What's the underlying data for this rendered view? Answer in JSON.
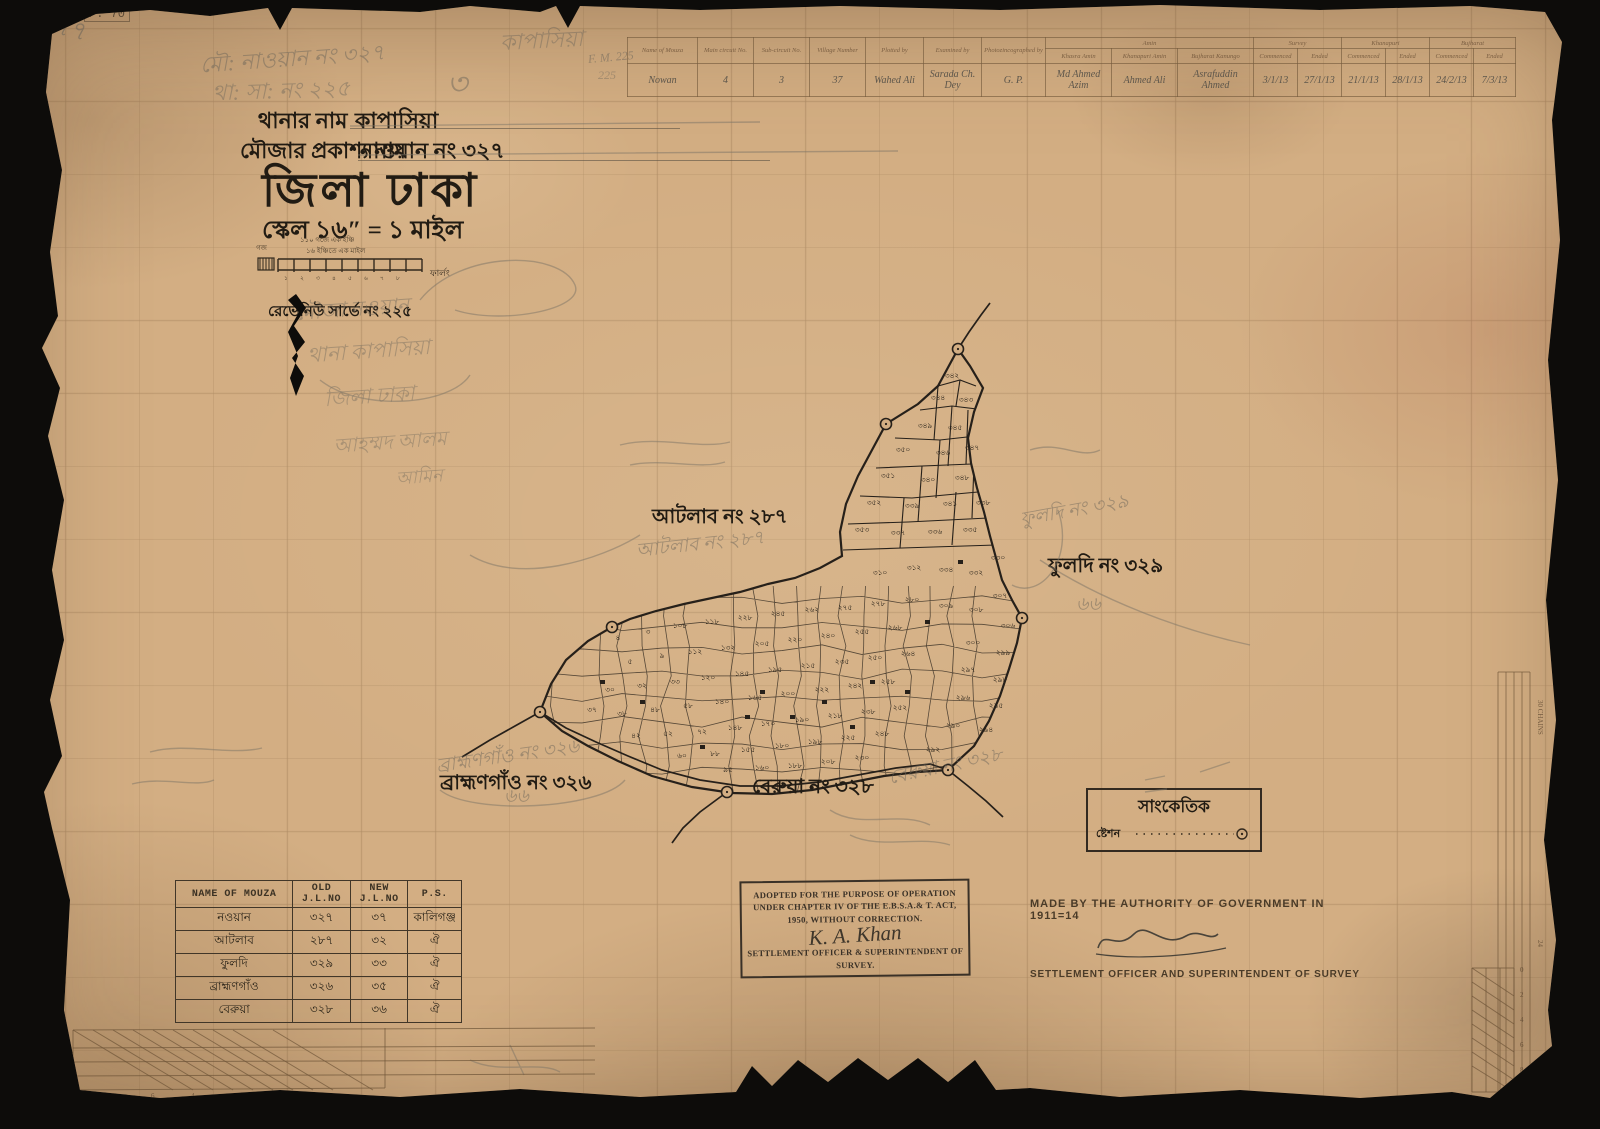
{
  "colors": {
    "paper": "#d3ae83",
    "ink": "#26201a",
    "pencil": "#6e675b",
    "faint_print": "#75583c"
  },
  "header": {
    "line1_label": "থানার নাম",
    "line1_value": "কাপাসিয়া",
    "line2_label": "মৌজার প্রকাশ্য নাম",
    "line2_value": "নাওয়ান নং ৩২৭",
    "district": "জিলা ঢাকা",
    "scale": "স্কেল ১৬″ = ১ মাইল",
    "scalebar_top": "১১০ গজে এক ইঞ্চি",
    "scalebar_bottom": "১৬ ইঞ্চিতে এক মাইল",
    "scalebar_left": "গজ",
    "scalebar_right": "ফার্লং",
    "revenue": "রেভেনিউ সার্ভে নং ২২৫"
  },
  "register": {
    "left_headers": [
      "Name of Mouza",
      "Main circuit No.",
      "Sub-circuit No.",
      "Village Number",
      "Plotted by",
      "Examined by",
      "Photozincographed by"
    ],
    "groups": [
      {
        "label": "Amin",
        "span": 3
      },
      {
        "label": "Survey",
        "span": 2
      },
      {
        "label": "Khanapuri",
        "span": 2
      },
      {
        "label": "Bujharat",
        "span": 2
      }
    ],
    "sub_headers": [
      "Khasra Amin",
      "Khanapuri Amin",
      "Bujharat Kanungo",
      "Commenced",
      "Ended",
      "Commenced",
      "Ended",
      "Commenced",
      "Ended"
    ],
    "row": [
      "Nowan",
      "4",
      "3",
      "37",
      "Wahed Ali",
      "Sarada Ch. Dey",
      "G. P.",
      "Md Ahmed Azim",
      "Ahmed Ali",
      "Asrafuddin Ahmed",
      "3/1/13",
      "27/1/13",
      "21/1/13",
      "28/1/13",
      "24/2/13",
      "7/3/13"
    ]
  },
  "map": {
    "labels": [
      {
        "text": "আটলাব নং ২৮৭",
        "x": 652,
        "y": 502
      },
      {
        "text": "ফুলদি নং ৩২৯",
        "x": 1048,
        "y": 551
      },
      {
        "text": "ব্রাহ্মণগাঁও নং ৩২৬",
        "x": 440,
        "y": 768
      },
      {
        "text": "বেরুয়া নং ৩২৮",
        "x": 752,
        "y": 772
      }
    ],
    "pencil_labels": [
      {
        "text": "আটলাব নং ২৮৭",
        "x": 636,
        "y": 530,
        "r": -6
      },
      {
        "text": "ফুলদি নং ৩২৯",
        "x": 1020,
        "y": 496,
        "r": -10
      },
      {
        "text": "৬৬",
        "x": 1076,
        "y": 590,
        "r": 0
      },
      {
        "text": "বেরুয়া নং ৩২৮",
        "x": 888,
        "y": 752,
        "r": -12
      },
      {
        "text": "ব্রাহ্মণগাঁও নং ৩২৬",
        "x": 436,
        "y": 742,
        "r": -8
      },
      {
        "text": "৬৬",
        "x": 504,
        "y": 782,
        "r": 0
      }
    ],
    "outline": [
      [
        958,
        349
      ],
      [
        938,
        386
      ],
      [
        918,
        404
      ],
      [
        886,
        424
      ],
      [
        872,
        450
      ],
      [
        858,
        476
      ],
      [
        846,
        504
      ],
      [
        840,
        532
      ],
      [
        842,
        556
      ],
      [
        820,
        568
      ],
      [
        795,
        578
      ],
      [
        768,
        584
      ],
      [
        740,
        592
      ],
      [
        712,
        598
      ],
      [
        684,
        604
      ],
      [
        656,
        611
      ],
      [
        630,
        619
      ],
      [
        612,
        627
      ],
      [
        588,
        641
      ],
      [
        566,
        660
      ],
      [
        551,
        684
      ],
      [
        540,
        712
      ],
      [
        562,
        731
      ],
      [
        588,
        746
      ],
      [
        618,
        761
      ],
      [
        652,
        776
      ],
      [
        692,
        787
      ],
      [
        732,
        793
      ],
      [
        772,
        794
      ],
      [
        812,
        790
      ],
      [
        848,
        783
      ],
      [
        884,
        776
      ],
      [
        918,
        772
      ],
      [
        948,
        770
      ],
      [
        974,
        746
      ],
      [
        989,
        721
      ],
      [
        1000,
        696
      ],
      [
        1009,
        669
      ],
      [
        1017,
        643
      ],
      [
        1022,
        618
      ],
      [
        1012,
        600
      ],
      [
        1002,
        580
      ],
      [
        996,
        558
      ],
      [
        990,
        536
      ],
      [
        984,
        512
      ],
      [
        977,
        488
      ],
      [
        971,
        463
      ],
      [
        968,
        438
      ],
      [
        974,
        412
      ],
      [
        983,
        388
      ],
      [
        970,
        366
      ]
    ],
    "segments": [
      [
        [
          938,
          386
        ],
        [
          960,
          380
        ],
        [
          976,
          386
        ]
      ],
      [
        [
          920,
          410
        ],
        [
          952,
          406
        ],
        [
          985,
          410
        ]
      ],
      [
        [
          895,
          438
        ],
        [
          940,
          440
        ],
        [
          976,
          436
        ]
      ],
      [
        [
          876,
          468
        ],
        [
          922,
          466
        ],
        [
          972,
          464
        ]
      ],
      [
        [
          860,
          496
        ],
        [
          912,
          498
        ],
        [
          978,
          492
        ]
      ],
      [
        [
          848,
          524
        ],
        [
          908,
          522
        ],
        [
          988,
          518
        ]
      ],
      [
        [
          843,
          550
        ],
        [
          902,
          548
        ],
        [
          996,
          545
        ]
      ],
      [
        [
          960,
          380
        ],
        [
          956,
          406
        ]
      ],
      [
        [
          938,
          386
        ],
        [
          934,
          440
        ]
      ],
      [
        [
          952,
          406
        ],
        [
          948,
          466
        ]
      ],
      [
        [
          922,
          466
        ],
        [
          918,
          522
        ]
      ],
      [
        [
          940,
          440
        ],
        [
          936,
          498
        ]
      ],
      [
        [
          968,
          410
        ],
        [
          966,
          464
        ]
      ],
      [
        [
          974,
          464
        ],
        [
          972,
          518
        ]
      ],
      [
        [
          904,
          498
        ],
        [
          900,
          548
        ]
      ],
      [
        [
          956,
          492
        ],
        [
          952,
          545
        ]
      ]
    ],
    "roads": [
      [
        [
          540,
          712
        ],
        [
          566,
          728
        ],
        [
          596,
          742
        ],
        [
          628,
          756
        ],
        [
          662,
          770
        ],
        [
          700,
          780
        ],
        [
          740,
          786
        ],
        [
          780,
          786
        ],
        [
          820,
          782
        ],
        [
          858,
          775
        ],
        [
          896,
          768
        ],
        [
          930,
          764
        ],
        [
          948,
          770
        ]
      ],
      [
        [
          727,
          792
        ],
        [
          700,
          812
        ],
        [
          683,
          828
        ],
        [
          672,
          843
        ]
      ],
      [
        [
          948,
          770
        ],
        [
          968,
          786
        ],
        [
          986,
          801
        ],
        [
          1003,
          817
        ]
      ],
      [
        [
          540,
          712
        ],
        [
          515,
          726
        ],
        [
          490,
          740
        ],
        [
          462,
          757
        ]
      ],
      [
        [
          958,
          349
        ],
        [
          969,
          332
        ],
        [
          981,
          315
        ],
        [
          990,
          303
        ]
      ]
    ],
    "stations": [
      [
        958,
        349
      ],
      [
        886,
        424
      ],
      [
        612,
        627
      ],
      [
        540,
        712
      ],
      [
        727,
        792
      ],
      [
        948,
        770
      ],
      [
        1022,
        618
      ]
    ],
    "houses": [
      [
        760,
        690
      ],
      [
        790,
        715
      ],
      [
        822,
        700
      ],
      [
        850,
        725
      ],
      [
        700,
        745
      ],
      [
        870,
        680
      ],
      [
        745,
        715
      ],
      [
        905,
        690
      ],
      [
        640,
        700
      ],
      [
        600,
        680
      ],
      [
        925,
        620
      ],
      [
        958,
        560
      ]
    ],
    "plots": [
      [
        952,
        378,
        "৩৪২"
      ],
      [
        938,
        400,
        "৩৪৪"
      ],
      [
        966,
        402,
        "৩৪৩"
      ],
      [
        925,
        428,
        "৩৪৯"
      ],
      [
        955,
        430,
        "৩৪৫"
      ],
      [
        903,
        452,
        "৩৫০"
      ],
      [
        943,
        455,
        "৩৪৬"
      ],
      [
        972,
        450,
        "৩৪৭"
      ],
      [
        888,
        478,
        "৩৫১"
      ],
      [
        928,
        482,
        "৩৪০"
      ],
      [
        962,
        480,
        "৩৪৮"
      ],
      [
        874,
        505,
        "৩৫২"
      ],
      [
        912,
        508,
        "৩৩৯"
      ],
      [
        950,
        506,
        "৩৪১"
      ],
      [
        983,
        505,
        "৩৩৮"
      ],
      [
        862,
        532,
        "৩৫৩"
      ],
      [
        898,
        535,
        "৩৩৭"
      ],
      [
        935,
        534,
        "৩৩৬"
      ],
      [
        970,
        532,
        "৩৩৫"
      ],
      [
        998,
        560,
        "৩৩০"
      ],
      [
        976,
        575,
        "৩৩২"
      ],
      [
        946,
        572,
        "৩৩৪"
      ],
      [
        914,
        570,
        "৩১২"
      ],
      [
        880,
        575,
        "৩১০"
      ],
      [
        1000,
        598,
        "৩০৭"
      ],
      [
        1008,
        628,
        "৩০৬"
      ],
      [
        976,
        612,
        "৩০৮"
      ],
      [
        946,
        608,
        "৩০৯"
      ],
      [
        1003,
        655,
        "২৯৯"
      ],
      [
        973,
        645,
        "৩০০"
      ],
      [
        1000,
        682,
        "২৯৮"
      ],
      [
        968,
        672,
        "২৯৭"
      ],
      [
        996,
        708,
        "২৯৫"
      ],
      [
        963,
        700,
        "২৯৬"
      ],
      [
        986,
        732,
        "২৯৪"
      ],
      [
        953,
        728,
        "২৯০"
      ],
      [
        933,
        752,
        "২৯২"
      ],
      [
        912,
        602,
        "২৮০"
      ],
      [
        878,
        606,
        "২৭৮"
      ],
      [
        845,
        610,
        "২৭৫"
      ],
      [
        812,
        612,
        "২৬২"
      ],
      [
        778,
        616,
        "২৪৫"
      ],
      [
        745,
        620,
        "২২৮"
      ],
      [
        712,
        624,
        "১১৮"
      ],
      [
        680,
        628,
        "১০৮"
      ],
      [
        648,
        634,
        "৩"
      ],
      [
        618,
        640,
        "৪"
      ],
      [
        895,
        630,
        "২৬৮"
      ],
      [
        862,
        634,
        "২৫৫"
      ],
      [
        828,
        638,
        "২৪০"
      ],
      [
        795,
        642,
        "২২০"
      ],
      [
        762,
        646,
        "২০৫"
      ],
      [
        728,
        650,
        "১৩২"
      ],
      [
        695,
        654,
        "১১২"
      ],
      [
        662,
        658,
        "৯"
      ],
      [
        630,
        664,
        "৫"
      ],
      [
        908,
        656,
        "২৬৪"
      ],
      [
        875,
        660,
        "২৫০"
      ],
      [
        842,
        664,
        "২৩৫"
      ],
      [
        808,
        668,
        "২১৫"
      ],
      [
        775,
        672,
        "১৯৫"
      ],
      [
        742,
        676,
        "১৪৫"
      ],
      [
        708,
        680,
        "১২০"
      ],
      [
        675,
        684,
        "৩৩"
      ],
      [
        642,
        688,
        "৩২"
      ],
      [
        610,
        692,
        "৩০"
      ],
      [
        888,
        684,
        "২৫৮"
      ],
      [
        855,
        688,
        "২৪২"
      ],
      [
        822,
        692,
        "২২২"
      ],
      [
        788,
        696,
        "২০০"
      ],
      [
        755,
        700,
        "১৬৫"
      ],
      [
        722,
        704,
        "১৪০"
      ],
      [
        688,
        708,
        "৫৮"
      ],
      [
        655,
        712,
        "৪৮"
      ],
      [
        622,
        716,
        "৩৮"
      ],
      [
        592,
        712,
        "৩৭"
      ],
      [
        900,
        710,
        "২৫২"
      ],
      [
        868,
        714,
        "২৩৮"
      ],
      [
        835,
        718,
        "২১৮"
      ],
      [
        802,
        722,
        "১৯০"
      ],
      [
        768,
        726,
        "১৭০"
      ],
      [
        735,
        730,
        "১৪৮"
      ],
      [
        702,
        734,
        "৭২"
      ],
      [
        668,
        736,
        "৫২"
      ],
      [
        636,
        738,
        "৪২"
      ],
      [
        882,
        736,
        "২৪৮"
      ],
      [
        848,
        740,
        "২২৫"
      ],
      [
        815,
        744,
        "১৯৮"
      ],
      [
        782,
        748,
        "১৮০"
      ],
      [
        748,
        752,
        "১৫৫"
      ],
      [
        715,
        756,
        "৮৮"
      ],
      [
        682,
        758,
        "৬০"
      ],
      [
        862,
        760,
        "২৩০"
      ],
      [
        828,
        764,
        "২০৮"
      ],
      [
        795,
        768,
        "১৮৮"
      ],
      [
        762,
        770,
        "১৬০"
      ],
      [
        728,
        772,
        "৯৫"
      ]
    ]
  },
  "legend": {
    "title": "সাংকেতিক",
    "item": "ষ্টেশন"
  },
  "mouza_table": {
    "headers": [
      "NAME OF MOUZA",
      "OLD J.L.NO",
      "NEW J.L.NO",
      "P.S."
    ],
    "rows": [
      [
        "নওয়ান",
        "৩২৭",
        "৩৭",
        "কালিগঞ্জ"
      ],
      [
        "আটলাব",
        "২৮৭",
        "৩২",
        "ঐ"
      ],
      [
        "ফুলদি",
        "৩২৯",
        "৩৩",
        "ঐ"
      ],
      [
        "ব্রাহ্মণগাঁও",
        "৩২৬",
        "৩৫",
        "ঐ"
      ],
      [
        "বেরুয়া",
        "৩২৮",
        "৩৬",
        "ঐ"
      ]
    ]
  },
  "stamp": {
    "line1": "ADOPTED FOR THE PURPOSE OF OPERATION",
    "line2": "UNDER CHAPTER IV OF THE E.B.S.A.& T. ACT,",
    "line3": "1950, WITHOUT CORRECTION.",
    "signature": "K. A. Khan",
    "line4": "SETTLEMENT OFFICER & SUPERINTENDENT OF",
    "line5": "SURVEY."
  },
  "authority": {
    "line1": "MADE BY THE AUTHORITY OF GOVERNMENT IN 1911=14",
    "line2": "SETTLEMENT OFFICER AND SUPERINTENDENT OF SURVEY"
  },
  "annotations": {
    "page_stamp": "P. 70",
    "corner_num": "৭৭",
    "fm": "F. M. 225",
    "fm2": "225",
    "top_center": "কাপাসিয়া",
    "top_line1": "মৌ: নাওয়ান নং ৩২৭",
    "top_line2": "থা: সা: নং ২২৫",
    "flourish": "৩",
    "left_block": [
      "মৌজা নওয়ান",
      "থানা কাপাসিয়া",
      "জিলা ঢাকা",
      "আহম্মদ আলম",
      "আমিন"
    ],
    "margin_right": [
      "30 CHAINS",
      "24",
      "20"
    ],
    "bl_scale_v": [
      "80",
      "60",
      "40",
      "20"
    ],
    "bl_scale_h": [
      "10",
      "8",
      "6",
      "4",
      "2",
      "0",
      "5"
    ],
    "br_scale": [
      "0",
      "2",
      "4",
      "6",
      "8",
      "10"
    ]
  }
}
